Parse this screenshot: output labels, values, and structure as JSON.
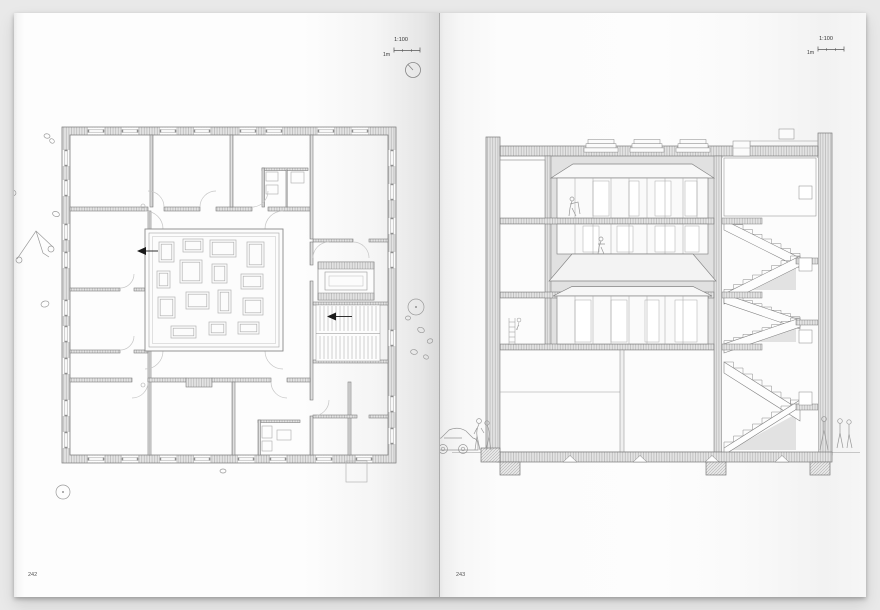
{
  "book": {
    "left_page": {
      "page_number": "242",
      "scale_ratio": "1:100",
      "scale_unit": "1m"
    },
    "right_page": {
      "page_number": "243",
      "scale_ratio": "1:100",
      "scale_unit": "1m"
    }
  },
  "icons": {
    "north_arrow": "north-arrow-icon",
    "section_cut_arrow": "section-cut-arrow-icon"
  },
  "colors": {
    "canvas_background": "#e9e9e9",
    "paper": "#fdfdfd",
    "drawing_line": "#7e7e7e",
    "wall_hatch": "#b6b6b6",
    "atrium_backdrop": "#e1e1e1",
    "section_marker": "#1a1a1a"
  }
}
